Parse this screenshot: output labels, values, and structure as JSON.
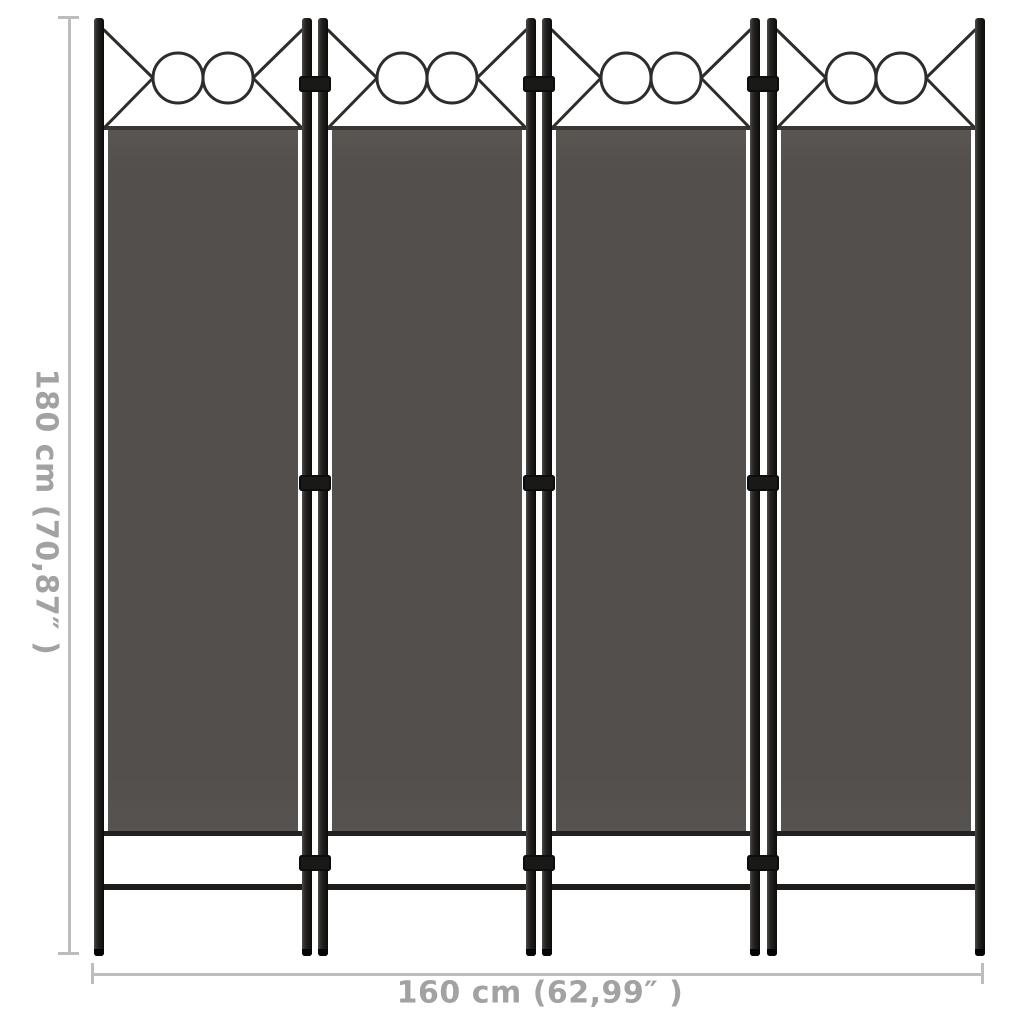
{
  "product": {
    "type": "4-panel room divider",
    "panel_count": 4,
    "circles_per_panel": 2,
    "hinge_rows": 3
  },
  "dimensions": {
    "height_label": "180 cm (70,87″ )",
    "width_label": "160 cm (62,99″ )"
  },
  "icons": {
    "top_decoration": "x-cross-with-double-circles"
  },
  "colors": {
    "background": "#ffffff",
    "fabric": "#534f4c",
    "frame": "#161616",
    "decoration_stroke": "#2e2d2c",
    "dimension_line": "#bdbdbd",
    "dimension_text": "#a2a2a2"
  }
}
